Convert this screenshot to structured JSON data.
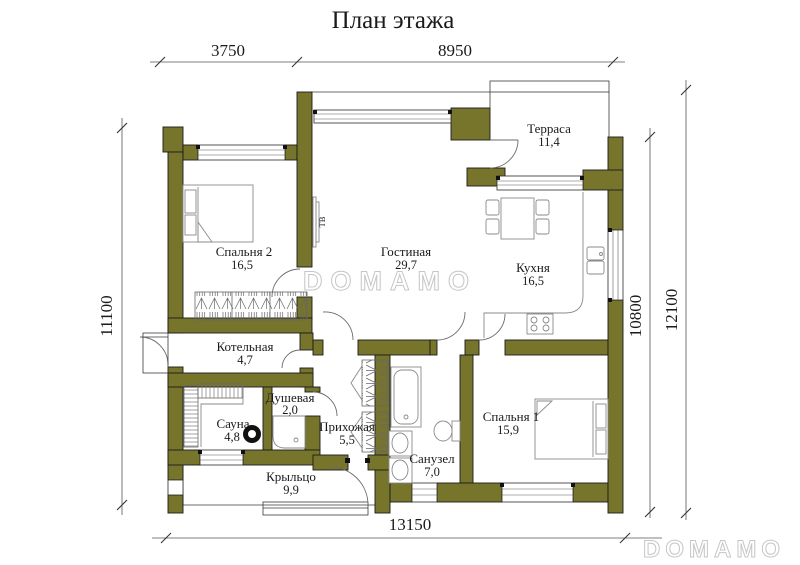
{
  "title": "План этажа",
  "watermark": {
    "center": "DOMAMO",
    "corner": "DOMAMO"
  },
  "colors": {
    "wall": "#77752c",
    "line": "#1a1a1a",
    "watermark": "#c6c6c6"
  },
  "dimensions": {
    "top": [
      "3750",
      "8950"
    ],
    "left": "11100",
    "right_inner": "10800",
    "right_outer": "12100",
    "bottom": "13150"
  },
  "labels": {
    "tv": "ТВ"
  },
  "rooms": [
    {
      "name": "Спальня 2",
      "area": "16,5"
    },
    {
      "name": "Гостиная",
      "area": "29,7"
    },
    {
      "name": "Терраса",
      "area": "11,4"
    },
    {
      "name": "Кухня",
      "area": "16,5"
    },
    {
      "name": "Котельная",
      "area": "4,7"
    },
    {
      "name": "Сауна",
      "area": "4,8"
    },
    {
      "name": "Душевая",
      "area": "2,0"
    },
    {
      "name": "Прихожая",
      "area": "5,5"
    },
    {
      "name": "Санузел",
      "area": "7,0"
    },
    {
      "name": "Спальня 1",
      "area": "15,9"
    },
    {
      "name": "Крыльцо",
      "area": "9,9"
    }
  ]
}
